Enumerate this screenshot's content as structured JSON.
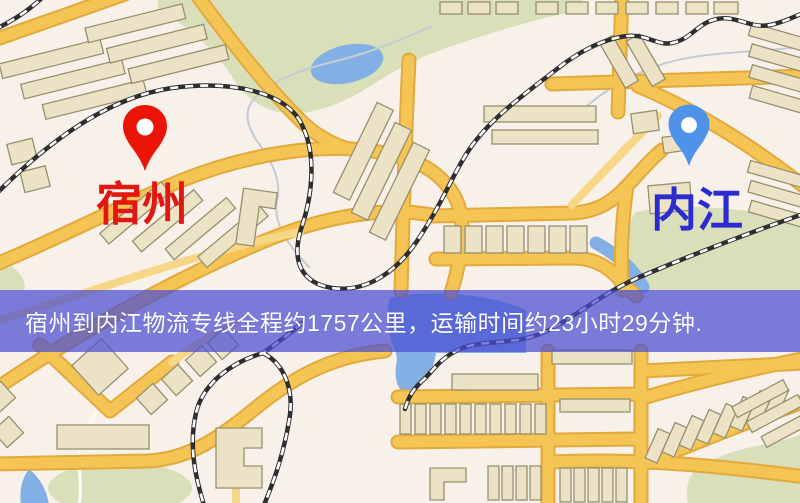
{
  "map": {
    "markers": [
      {
        "id": "origin",
        "label": "宿州",
        "pin_icon": "map-pin",
        "pin_color": "#ea1506",
        "label_color": "#e21711"
      },
      {
        "id": "destination",
        "label": "内江",
        "pin_icon": "map-pin",
        "pin_color": "#4e92ea",
        "label_color": "#2b2bd0"
      }
    ],
    "palette": {
      "background": "#f8f1ea",
      "road_fill": "#f4c555",
      "road_casing": "#e2a93c",
      "minor_road": "#f6d687",
      "building_fill": "#ece3c6",
      "building_outline": "#97906e",
      "park": "#d8dfb9",
      "water": "#82b0e4",
      "railway": "#2e2e2e"
    }
  },
  "banner": {
    "text": "宿州到内江物流专线全程约1757公里，运输时间约23小时29分钟.",
    "origin_city": "宿州",
    "destination_city": "内江",
    "distance_text": "约1757公里",
    "duration_text": "约23小时29分钟",
    "overlay_color": "#494dd3",
    "text_color": "#ffffff"
  }
}
